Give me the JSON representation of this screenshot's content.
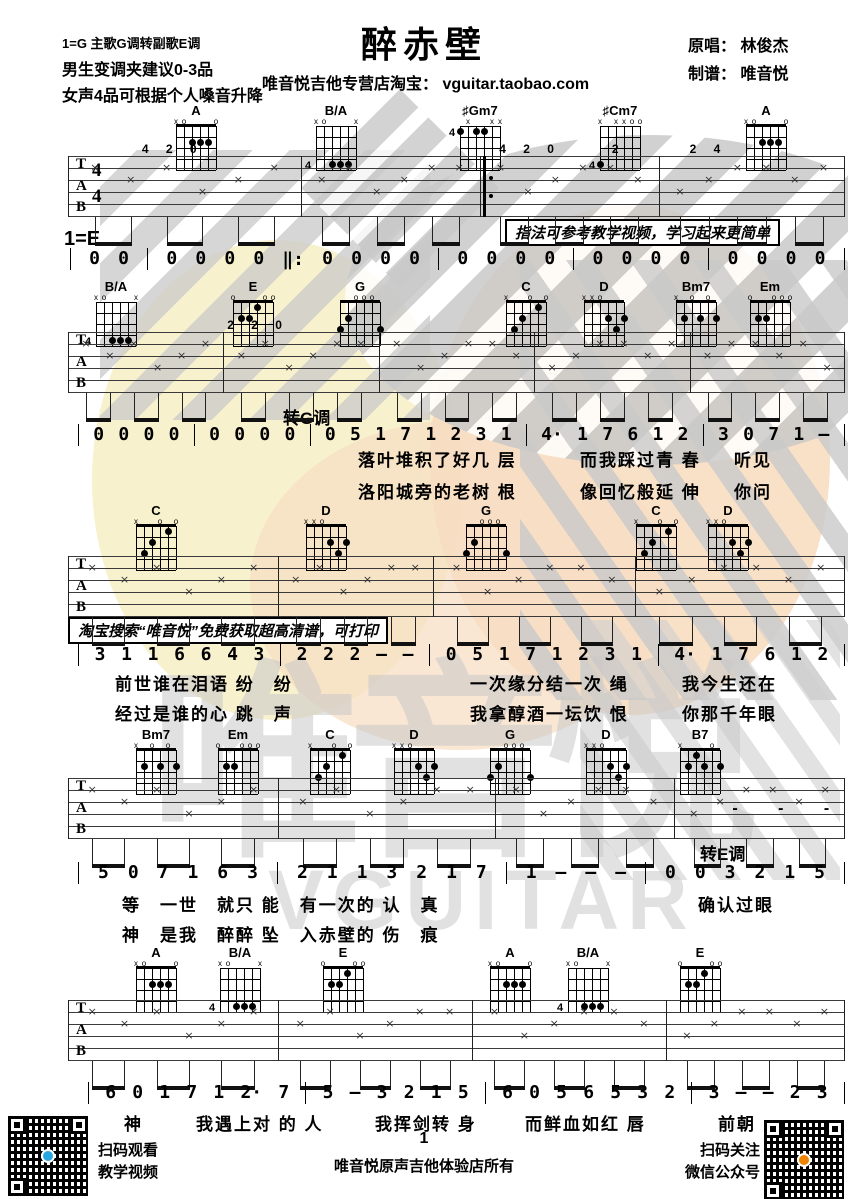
{
  "header": {
    "title": "醉赤壁",
    "tuning_line1": "1=G 主歌G调转副歌E调",
    "tuning_line2": "男生变调夹建议0-3品",
    "tuning_line3": "女声4品可根据个人嗓音升降",
    "store_line": "唯音悦吉他专营店淘宝： vguitar.taobao.com",
    "original_singer": "原唱： 林俊杰",
    "arranger": "制谱： 唯音悦"
  },
  "annotations": {
    "key_e": "1=E",
    "tip_box1": "指法可参考教学视频，学习起来更简单",
    "tip_box2": "淘宝搜索“唯音悦”免费获取超高清谱，可打印"
  },
  "chord_shapes": {
    "A": {
      "markers": [
        "x",
        "o",
        "",
        "",
        "",
        "o"
      ],
      "dots": [
        [
          2,
          2
        ],
        [
          3,
          2
        ],
        [
          4,
          2
        ]
      ]
    },
    "B/A": {
      "fret": "4",
      "markers": [
        "x",
        "o",
        "",
        "",
        "",
        "x"
      ],
      "dots": [
        [
          2,
          4
        ],
        [
          3,
          4
        ],
        [
          4,
          4
        ]
      ]
    },
    "♯Gm7": {
      "fret": "4",
      "markers": [
        "",
        "x",
        "",
        "",
        "x",
        "x"
      ],
      "dots": [
        [
          0,
          1
        ],
        [
          2,
          1
        ],
        [
          3,
          1
        ]
      ]
    },
    "♯Cm7": {
      "fret": "4",
      "markers": [
        "x",
        "",
        "x",
        "x",
        "o",
        "o"
      ],
      "dots": [
        [
          0,
          4
        ]
      ]
    },
    "E": {
      "markers": [
        "o",
        "",
        "",
        "",
        "o",
        "o"
      ],
      "dots": [
        [
          1,
          2
        ],
        [
          2,
          2
        ],
        [
          3,
          1
        ]
      ]
    },
    "G": {
      "markers": [
        "",
        "",
        "o",
        "o",
        "o",
        ""
      ],
      "dots": [
        [
          0,
          3
        ],
        [
          1,
          2
        ],
        [
          5,
          3
        ]
      ]
    },
    "C": {
      "markers": [
        "x",
        "",
        "",
        "o",
        "",
        "o"
      ],
      "dots": [
        [
          1,
          3
        ],
        [
          2,
          2
        ],
        [
          4,
          1
        ]
      ]
    },
    "D": {
      "markers": [
        "x",
        "x",
        "o",
        "",
        "",
        ""
      ],
      "dots": [
        [
          3,
          2
        ],
        [
          5,
          2
        ],
        [
          4,
          3
        ]
      ]
    },
    "Bm7": {
      "markers": [
        "x",
        "",
        "o",
        "",
        "o",
        ""
      ],
      "dots": [
        [
          1,
          2
        ],
        [
          3,
          2
        ],
        [
          5,
          2
        ]
      ]
    },
    "Em": {
      "markers": [
        "o",
        "",
        "",
        "o",
        "o",
        "o"
      ],
      "dots": [
        [
          1,
          2
        ],
        [
          2,
          2
        ]
      ]
    },
    "B7": {
      "markers": [
        "x",
        "",
        "",
        "",
        "o",
        ""
      ],
      "dots": [
        [
          2,
          1
        ],
        [
          1,
          2
        ],
        [
          3,
          2
        ],
        [
          5,
          2
        ]
      ]
    }
  },
  "systems": [
    {
      "chords": [
        "A",
        "B/A",
        "♯Gm7",
        "♯Cm7",
        "A"
      ],
      "numbers": "| 0 0 | 0 0 0 0 ‖: 0 0 0 0 | 0 0 0 0 | 0 0 0 0 | 0 0 0 0 |",
      "lyrics": []
    },
    {
      "chords": [
        "B/A",
        "E",
        "G",
        "C",
        "D",
        "Bm7",
        "Em"
      ],
      "key_change": "转G调",
      "numbers": "| 0 0 0 0 | 0 0 0 0 | 0 5 1 7 1 2 3 1 | 4· 1 7 6 1 2 | 3 0 7 1 – |",
      "lyrics": [
        [
          "落叶堆积了好几 层",
          "而我踩过青 春",
          "听见"
        ],
        [
          "洛阳城旁的老树 根",
          "像回忆般延 伸",
          "你问"
        ]
      ]
    },
    {
      "chords": [
        "C",
        "D",
        "G",
        "C",
        "D"
      ],
      "numbers": "| 3 1 1 6 6 4 3 | 2 2 2 – – | 0 5 1 7 1 2 3 1 | 4· 1 7 6 1 2 |",
      "lyrics": [
        [
          "前世谁在泪语 纷　纷",
          "一次缘分结一次 绳",
          "我今生还在"
        ],
        [
          "经过是谁的心 跳　声",
          "我拿醇酒一坛饮 恨",
          "你那千年眼"
        ]
      ]
    },
    {
      "chords": [
        "Bm7",
        "Em",
        "C",
        "D",
        "G",
        "D",
        "B7"
      ],
      "key_change": "转E调",
      "numbers": "| 5 0 7 1 6 3 | 2 1 1 3 2 1 7 | 1 – – – | 0 0 3 2 1 5 |",
      "lyrics": [
        [
          "等　一世　就只 能　有一次的 认　真",
          "确认过眼"
        ],
        [
          "神　是我　醉醉 坠　入赤壁的 伤　痕"
        ]
      ]
    },
    {
      "chords": [
        "A",
        "B/A",
        "E",
        "A",
        "B/A",
        "E"
      ],
      "numbers": "| 6 0 1 7 1 2· 7 | 5 – 3 2 1 5 | 6 0 5 6 5 3 2 | 3 – – 2 3 |",
      "lyrics": [
        [
          "神",
          "我遇上对 的 人",
          "我挥剑转 身",
          "而鲜血如红 唇",
          "前朝"
        ]
      ]
    }
  ],
  "watermark": {
    "name": "唯音悦",
    "latin": "VGUITAR"
  },
  "footer": {
    "page_number": "1",
    "rights": "唯音悦原声吉他体验店所有",
    "qr_left_line1": "扫码观看",
    "qr_left_line2": "教学视频",
    "qr_right_line1": "扫码关注",
    "qr_right_line2": "微信公众号",
    "qr_left_logo_color": "#2aa7e0",
    "qr_right_logo_color": "#f08300"
  }
}
